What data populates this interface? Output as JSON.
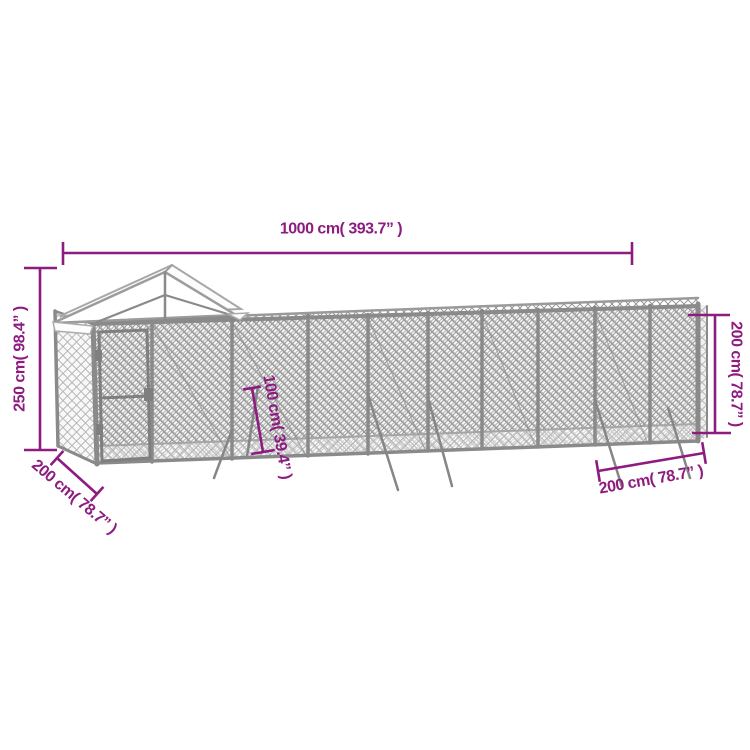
{
  "canvas": {
    "width": 750,
    "height": 750,
    "background": "#ffffff"
  },
  "colors": {
    "dimension": "#8E1B80",
    "frame": "#8a8a8a",
    "frame_light": "#a6a6a6",
    "mesh": "#8f8f8f",
    "mesh_light": "#b3b3b3",
    "roof_fill": "#fdfdfd",
    "roof_edge": "#9c9c9c"
  },
  "dimensions": {
    "length_top": {
      "label": "1000 cm( 393.7” )"
    },
    "height_left": {
      "label": "250 cm( 98.4” )"
    },
    "depth_front_left": {
      "label": "200 cm( 78.7” )"
    },
    "brace_center": {
      "label": "100 cm( 39.4” )"
    },
    "height_right": {
      "label": "200 cm( 78.7” )"
    },
    "depth_bottom_right": {
      "label": "200 cm( 78.7” )"
    }
  }
}
